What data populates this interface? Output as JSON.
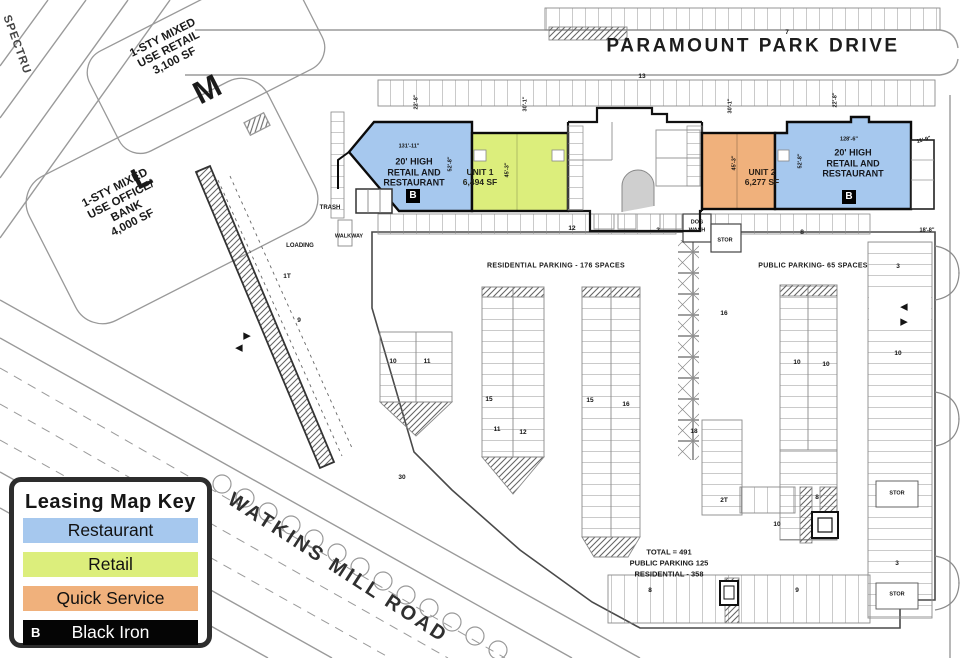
{
  "legend": {
    "title": "Leasing Map Key",
    "items": [
      {
        "label": "Restaurant",
        "color": "#a6c8ee",
        "text": "#111111"
      },
      {
        "label": "Retail",
        "color": "#dcee7c",
        "text": "#111111"
      },
      {
        "label": "Quick Service",
        "color": "#f0b17c",
        "text": "#111111"
      },
      {
        "label": "Black Iron",
        "color": "#050505",
        "text": "#ffffff",
        "badge": "B"
      }
    ]
  },
  "colors": {
    "restaurant": "#a6c8ee",
    "retail": "#dcee7c",
    "quick_service": "#f0b17c",
    "black_iron": "#050505"
  },
  "roads": {
    "paramount_park_drive": "PARAMOUNT PARK DRIVE",
    "watkins_mill_road": "WATKINS MILL ROAD",
    "spectrum": "SPECTRU"
  },
  "parcels": {
    "m": {
      "letter": "M",
      "lines": [
        "1-STY MIXED",
        "USE RETAIL",
        "3,100 SF"
      ]
    },
    "l": {
      "letter": "L",
      "lines": [
        "1-STY MIXED",
        "USE OFFICE/",
        "BANK",
        "4,000 SF"
      ]
    }
  },
  "units": {
    "restaurant_left": {
      "lines": [
        "20' HIGH",
        "RETAIL AND",
        "RESTAURANT"
      ],
      "badge": "B"
    },
    "unit1": {
      "name": "UNIT 1",
      "area": "6,494 SF"
    },
    "unit2": {
      "name": "UNIT 2",
      "area": "6,277 SF"
    },
    "restaurant_right": {
      "lines": [
        "20' HIGH",
        "RETAIL AND",
        "RESTAURANT"
      ],
      "badge": "B"
    }
  },
  "parking": {
    "residential_label": "RESIDENTIAL PARKING - 176 SPACES",
    "public_label": "PUBLIC PARKING- 65 SPACES",
    "totals": [
      "TOTAL = 491",
      "PUBLIC PARKING 125",
      "RESIDENTIAL - 358"
    ]
  },
  "annotations": [
    {
      "t": "22'-8\"",
      "x": 417,
      "y": 102,
      "r": -90,
      "s": 5.5,
      "w": 600,
      "n": "dimension-label"
    },
    {
      "t": "30'-1\"",
      "x": 526,
      "y": 104,
      "r": -90,
      "s": 5.5,
      "w": 600,
      "n": "dimension-label"
    },
    {
      "t": "30'-1\"",
      "x": 731,
      "y": 106,
      "r": -90,
      "s": 5.5,
      "w": 600,
      "n": "dimension-label"
    },
    {
      "t": "22'-8\"",
      "x": 836,
      "y": 100,
      "r": -90,
      "s": 5.5,
      "w": 600,
      "n": "dimension-label"
    },
    {
      "t": "131'-11\"",
      "x": 409,
      "y": 147,
      "s": 5.5,
      "w": 600,
      "n": "dimension-label"
    },
    {
      "t": "52'-8\"",
      "x": 451,
      "y": 164,
      "r": -90,
      "s": 5.5,
      "w": 600,
      "n": "dimension-label"
    },
    {
      "t": "45'-3\"",
      "x": 508,
      "y": 170,
      "r": -90,
      "s": 5.5,
      "w": 600,
      "n": "dimension-label"
    },
    {
      "t": "45'-3\"",
      "x": 735,
      "y": 163,
      "r": -90,
      "s": 5.5,
      "w": 600,
      "n": "dimension-label"
    },
    {
      "t": "52'-8\"",
      "x": 801,
      "y": 161,
      "r": -90,
      "s": 5.5,
      "w": 600,
      "n": "dimension-label"
    },
    {
      "t": "128'-6\"",
      "x": 849,
      "y": 140,
      "s": 5.5,
      "w": 600,
      "n": "dimension-label"
    },
    {
      "t": "11'-9\"",
      "x": 924,
      "y": 141,
      "r": -15,
      "s": 5.5,
      "w": 600,
      "n": "dimension-label"
    },
    {
      "t": "18'-8\"",
      "x": 927,
      "y": 231,
      "s": 5.5,
      "w": 600,
      "n": "dimension-label"
    },
    {
      "t": "7",
      "x": 787,
      "y": 33,
      "n": "stall-count"
    },
    {
      "t": "13",
      "x": 642,
      "y": 77,
      "n": "stall-count"
    },
    {
      "t": "12",
      "x": 572,
      "y": 229,
      "n": "stall-count"
    },
    {
      "t": "3",
      "x": 658,
      "y": 231,
      "n": "stall-count"
    },
    {
      "t": "8",
      "x": 802,
      "y": 233,
      "n": "stall-count"
    },
    {
      "t": "10",
      "x": 393,
      "y": 362,
      "n": "stall-count"
    },
    {
      "t": "11",
      "x": 427,
      "y": 362,
      "n": "stall-count"
    },
    {
      "t": "15",
      "x": 489,
      "y": 400,
      "n": "stall-count"
    },
    {
      "t": "11",
      "x": 497,
      "y": 430,
      "n": "stall-count"
    },
    {
      "t": "12",
      "x": 523,
      "y": 433,
      "n": "stall-count"
    },
    {
      "t": "15",
      "x": 590,
      "y": 401,
      "n": "stall-count"
    },
    {
      "t": "16",
      "x": 626,
      "y": 405,
      "n": "stall-count"
    },
    {
      "t": "16",
      "x": 724,
      "y": 314,
      "n": "stall-count"
    },
    {
      "t": "3",
      "x": 898,
      "y": 267,
      "n": "stall-count"
    },
    {
      "t": "10",
      "x": 797,
      "y": 363,
      "n": "stall-count"
    },
    {
      "t": "10",
      "x": 826,
      "y": 365,
      "n": "stall-count"
    },
    {
      "t": "10",
      "x": 898,
      "y": 354,
      "n": "stall-count"
    },
    {
      "t": "18",
      "x": 694,
      "y": 432,
      "n": "stall-count"
    },
    {
      "t": "2T",
      "x": 724,
      "y": 501,
      "n": "stall-count"
    },
    {
      "t": "1T",
      "x": 287,
      "y": 277,
      "n": "stall-count"
    },
    {
      "t": "9",
      "x": 299,
      "y": 321,
      "n": "stall-count"
    },
    {
      "t": "30",
      "x": 402,
      "y": 478,
      "n": "stall-count"
    },
    {
      "t": "8",
      "x": 817,
      "y": 498,
      "n": "stall-count"
    },
    {
      "t": "10",
      "x": 777,
      "y": 525,
      "n": "stall-count"
    },
    {
      "t": "3",
      "x": 897,
      "y": 564,
      "n": "stall-count"
    },
    {
      "t": "9",
      "x": 797,
      "y": 591,
      "n": "stall-count"
    },
    {
      "t": "8",
      "x": 650,
      "y": 591,
      "n": "stall-count"
    },
    {
      "t": "STOR",
      "x": 897,
      "y": 494,
      "s": 5.5,
      "n": "storage-label"
    },
    {
      "t": "STOR",
      "x": 897,
      "y": 595,
      "s": 5.5,
      "n": "storage-label"
    },
    {
      "t": "STOR",
      "x": 725,
      "y": 241,
      "s": 5.5,
      "n": "storage-label"
    },
    {
      "t": "DOG",
      "x": 697,
      "y": 223,
      "s": 5.5,
      "n": "dog-wash-label"
    },
    {
      "t": "WASH",
      "x": 697,
      "y": 231,
      "s": 5.5,
      "n": "dog-wash-label"
    },
    {
      "t": "TRASH",
      "x": 330,
      "y": 208,
      "s": 6,
      "n": "trash-label"
    },
    {
      "t": "WALKWAY",
      "x": 349,
      "y": 237,
      "s": 5.5,
      "n": "walkway-label"
    },
    {
      "t": "LOADING",
      "x": 300,
      "y": 246,
      "s": 6,
      "n": "loading-label"
    },
    {
      "t": "◀",
      "x": 904,
      "y": 307,
      "s": 9,
      "n": "direction-arrow"
    },
    {
      "t": "▶",
      "x": 904,
      "y": 322,
      "s": 9,
      "n": "direction-arrow"
    },
    {
      "t": "▶",
      "x": 247,
      "y": 336,
      "s": 9,
      "n": "direction-arrow"
    },
    {
      "t": "◀",
      "x": 239,
      "y": 348,
      "s": 9,
      "n": "direction-arrow"
    }
  ]
}
